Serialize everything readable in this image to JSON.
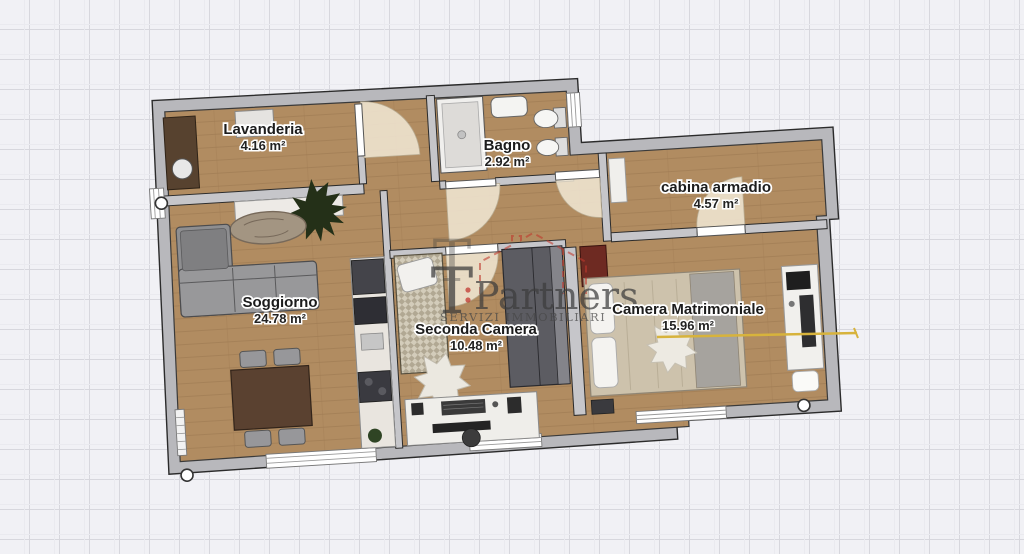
{
  "rooms": [
    {
      "name": "Lavanderia",
      "area": "4.16 m²"
    },
    {
      "name": "Bagno",
      "area": "2.92 m²"
    },
    {
      "name": "cabina armadio",
      "area": "4.57 m²"
    },
    {
      "name": "Soggiorno",
      "area": "24.78 m²"
    },
    {
      "name": "Seconda Camera",
      "area": "10.48 m²"
    },
    {
      "name": "Camera Matrimoniale",
      "area": "15.96 m²"
    }
  ],
  "watermark": {
    "t_upper": "T",
    "t_lower": "T",
    "brand": "Partners",
    "tagline": "SERVIZI IMMOBILIARI"
  },
  "colors": {
    "canvas": "#f1f1f5",
    "grid": "#d7d7dd",
    "wall": "#b8b8bc",
    "floor_wood": "#b18c61",
    "logo_red": "#bf382d",
    "measure_line": "#d7b33c"
  }
}
